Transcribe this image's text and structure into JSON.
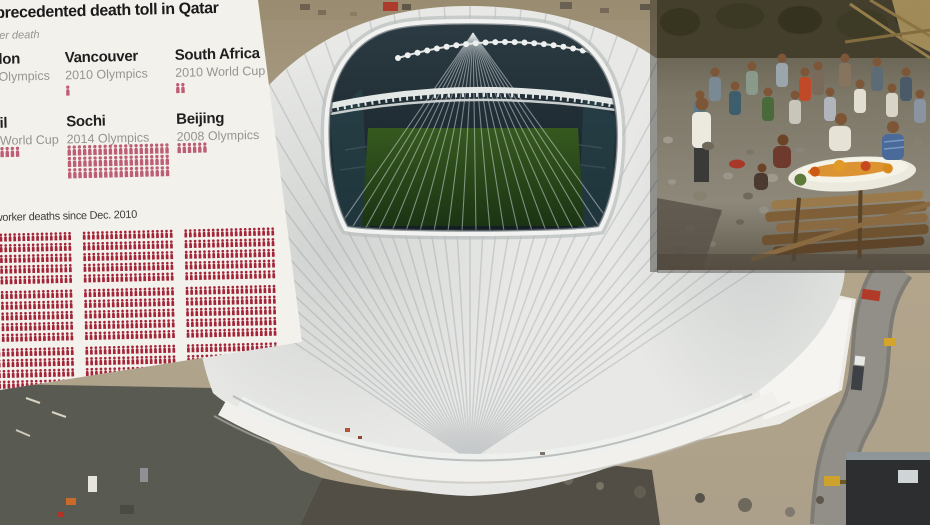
{
  "meta": {
    "kind": "news photo composite",
    "canvas": {
      "width": 930,
      "height": 525
    }
  },
  "scene": {
    "stadium_description": "Aerial view of the Al Wakrah (Al Janoub) 2022 World Cup stadium under construction in Qatar, white pleated roof with open center showing the green pitch",
    "inset_description": "Mourners gathered around the body of a migrant worker laid on a wooden funeral pyre",
    "palette": {
      "sand": "#ab9d83",
      "roof_white": "#e8e9e6",
      "rib_gray": "#c6c9ca",
      "pitch_green": "#2c4f1e",
      "bowl_dark": "#1c262d",
      "pavement": "#5c5c55",
      "road": "#908e86"
    }
  },
  "infographic": {
    "title": "Unprecedented death toll in Qatar",
    "legend": {
      "icon": "person-icon",
      "text": "= 1 worker death"
    },
    "columns": [
      {
        "name": "London",
        "event": "2012 Olympics",
        "deaths": 0
      },
      {
        "name": "Vancouver",
        "event": "2010 Olympics",
        "deaths": 1
      },
      {
        "name": "South Africa",
        "event": "2010 World Cup",
        "deaths": 2
      },
      {
        "name": "Brazil",
        "event": "2014 World Cup",
        "deaths": 10
      },
      {
        "name": "Sochi",
        "event": "2014 Olympics",
        "deaths": 60
      },
      {
        "name": "Beijing",
        "event": "2008 Olympics",
        "deaths": 6
      }
    ],
    "qatar": {
      "caption": "Qatar: 1,200 worker deaths since Dec. 2010",
      "deaths": 1200
    },
    "colors": {
      "panel_bg": "#f3f1ec",
      "title": "#1a1a1a",
      "heading": "#1f1f1f",
      "subtext": "#97948f",
      "caption": "#3e3c39",
      "icon_small": "#bd5e74",
      "icon_grid": "#a42438"
    }
  },
  "chart_data": {
    "type": "pictogram",
    "title": "Unprecedented death toll in Qatar",
    "unit_label": "= 1 worker death",
    "categories": [
      "London 2012 Olympics",
      "Vancouver 2010 Olympics",
      "South Africa 2010 World Cup",
      "Brazil 2014 World Cup",
      "Sochi 2014 Olympics",
      "Beijing 2008 Olympics",
      "Qatar (since Dec. 2010)"
    ],
    "values": [
      0,
      1,
      2,
      10,
      60,
      6,
      1200
    ],
    "legend_position": "top-left",
    "notes": "One figure icon equals one construction-worker death; Qatar total shown as a large grid of 1,200 figures in 20x5 blocks; left column of the graphic is cropped by the image edge"
  }
}
